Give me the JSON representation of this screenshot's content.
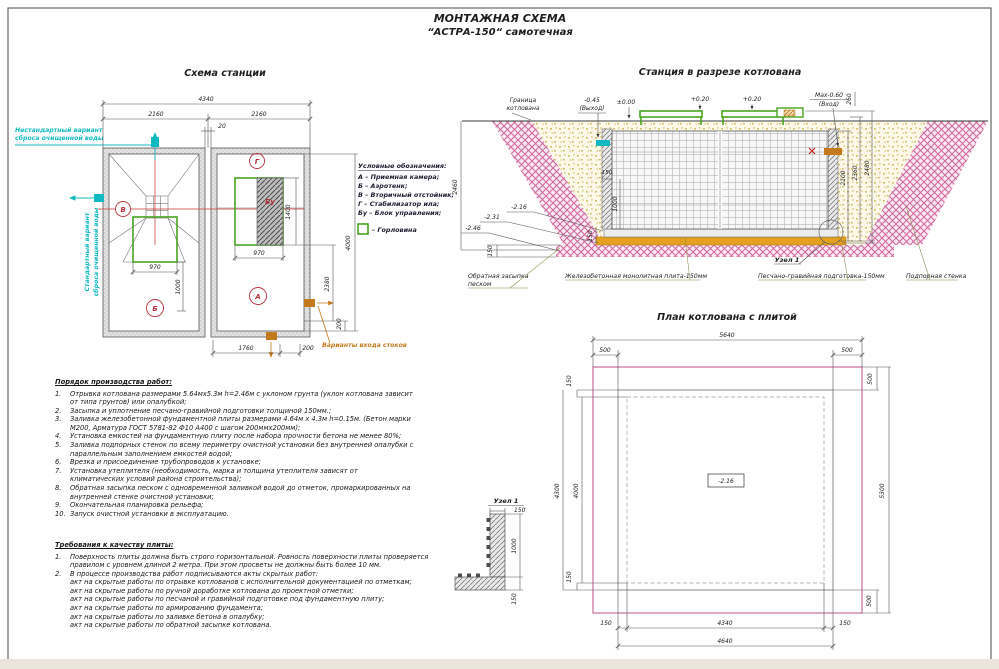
{
  "sheet": {
    "title_line1": "МОНТАЖНАЯ СХЕМА",
    "title_line2": "“АСТРА-150“ самотечная"
  },
  "station_plan": {
    "title": "Схема станции",
    "dim_4340": "4340",
    "dim_2160_left": "2160",
    "dim_20": "20",
    "dim_2160_right": "2160",
    "dim_970_left": "970",
    "dim_1000_left": "1000",
    "dim_970_right": "970",
    "dim_1400": "1400",
    "dim_2380": "2380",
    "dim_200_right": "200",
    "dim_4000": "4000",
    "dim_1760": "1760",
    "dim_200_bottom": "200",
    "label_a": "А",
    "label_b": "Б",
    "label_v": "В",
    "label_g": "Г",
    "label_bu": "Бу",
    "note_nonstandard_1": "Нестандартный вариант",
    "note_nonstandard_2": "сброса очищенной воды",
    "note_standard_1": "Стандартный вариант",
    "note_standard_2": "сброса очищенной воды",
    "note_inlet": "Варианты входа стоков",
    "legend_title": "Условные обозначения:",
    "legend_a": "А – Приемная камера;",
    "legend_b": "Б – Аэротенк;",
    "legend_v": "В – Вторичный отстойник;",
    "legend_g": "Г – Стабилизатор ила;",
    "legend_bu": "Бу – Блок управления;",
    "legend_gorlovina": "– Горловина"
  },
  "cross_section": {
    "title": "Станция в разрезе котлована",
    "pit_boundary_1": "Граница",
    "pit_boundary_2": "котлована",
    "lvl_out_1": "-0.45",
    "lvl_out_2": "(Выход)",
    "lvl_zero": "±0.00",
    "lvl_plus020_a": "+0.20",
    "lvl_plus020_b": "+0.20",
    "lvl_max_1": "Max-0.60",
    "lvl_max_2": "(Вход)",
    "dim_260": "260",
    "dim_2100": "2100",
    "dim_2360": "2360",
    "dim_2480": "2480",
    "dim_2460": "2460",
    "dim_150_band": "150",
    "dim_150_wall": "150",
    "dim_1000_wall": "1000",
    "dim_150_base": "150",
    "lvl_216": "-2.16",
    "lvl_231": "-2.31",
    "lvl_246": "-2.46",
    "callout_backfill_1": "Обратная засыпка",
    "callout_backfill_2": "песком",
    "callout_plate": "Железобетонная монолитная плита-150мм",
    "callout_node": "Узел 1",
    "callout_prep": "Песчано-гравийная подготовка-150мм",
    "callout_wall": "Подпорная стенка"
  },
  "pit_plan": {
    "title": "План котлована с плитой",
    "dim_5640": "5640",
    "dim_500_tl": "500",
    "dim_500_tr": "500",
    "dim_150_lt": "150",
    "dim_4300": "4300",
    "dim_4000": "4000",
    "dim_150_lb": "150",
    "dim_500_rt": "500",
    "dim_5300": "5300",
    "dim_500_rb": "500",
    "dim_150_bl": "150",
    "dim_4340": "4340",
    "dim_150_br": "150",
    "dim_4640": "4640",
    "level_box": "-2.16"
  },
  "node_detail": {
    "title": "Узел 1",
    "dim_150_top": "150",
    "dim_1000": "1000",
    "dim_150_bottom": "150"
  },
  "work_order": {
    "title": "Порядок производства работ:",
    "items": [
      {
        "n": "1.",
        "t": "Отрывка котлована размерами 5.64мх5.3м h=2.46м с уклоном грунта (уклон котлована зависит\nот типа грунтов) или опалубкой;"
      },
      {
        "n": "2.",
        "t": "Засыпка и уплотнение песчано-гравийной подготовки толщиной 150мм.;"
      },
      {
        "n": "3.",
        "t": "Заливка железобетонной фундаментной плиты размерами 4.64м х 4.3м h=0.15м. (Бетон марки\nМ200, Арматура ГОСТ 5781-82 Ф10 А400 с шагом 200ммх200мм);"
      },
      {
        "n": "4.",
        "t": "Установка емкостей на фундаментную плиту после набора прочности бетона не менее 80%;"
      },
      {
        "n": "5.",
        "t": "Заливка подпорных стенок по всему периметру очистной установки без внутренней опалубки с\nпараллельным заполнением емкостей водой;"
      },
      {
        "n": "6.",
        "t": "Врезка и присоединение трубопроводов к установке;"
      },
      {
        "n": "7.",
        "t": "Установка утеплителя (необходимость, марка и толщина утеплителя зависят от\nклиматических условий района строительства);"
      },
      {
        "n": "8.",
        "t": "Обратная засыпка песком с одновременной заливкой водой до отметок, промаркированных на\nвнутренней стенке очистной установки;"
      },
      {
        "n": "9.",
        "t": "Окончательная планировка рельефа;"
      },
      {
        "n": "10.",
        "t": "Запуск очистной установки в эксплуатацию."
      }
    ]
  },
  "quality": {
    "title": "Требования к качеству плиты:",
    "items": [
      {
        "n": "1.",
        "t": "Поверхность плиты должна быть строго горизонтальной. Ровность поверхности плиты проверяется\nправилом с уровнем длиной 2 метра. При этом просветы не должны быть более 10 мм."
      },
      {
        "n": "2.",
        "t": "В процессе производства работ подписываются акты скрытых работ:\nакт на скрытые работы по отрывке котлованов с исполнительной документацией по отметкам;\nакт на скрытые работы по ручной доработке котлована до проектной отметки;\nакт на скрытые работы по песчаной и гравийной подготовке под фундаментную плиту;\nакт на скрытые работы по армированию фундамента;\nакт на скрытые работы по заливке бетона в опалубку;\nакт на скрытые работы по обратной засыпке котлована."
      }
    ]
  }
}
